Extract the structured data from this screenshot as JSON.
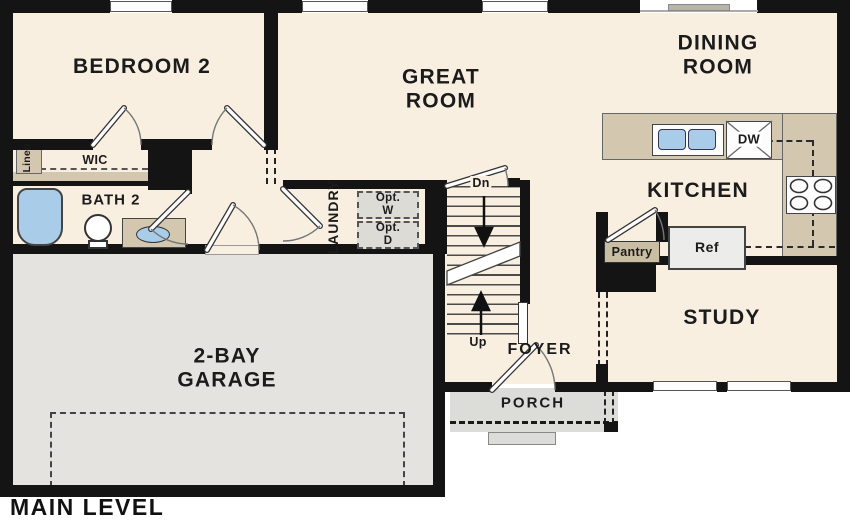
{
  "plan_title": "MAIN LEVEL",
  "labels": {
    "bedroom2": "BEDROOM 2",
    "great_room": "GREAT\nROOM",
    "dining_room": "DINING\nROOM",
    "kitchen": "KITCHEN",
    "study": "STUDY",
    "bath2": "BATH 2",
    "wic": "WIC",
    "linen": "Linen",
    "laundry": "LAUNDRY",
    "foyer": "FOYER",
    "porch": "PORCH",
    "garage": "2-BAY\nGARAGE"
  },
  "fixtures": {
    "pantry": "Pantry",
    "ref": "Ref",
    "dishwasher": "DW",
    "opt_washer": "Opt.\nW",
    "opt_dryer": "Opt.\nD"
  },
  "stairs": {
    "down": "Dn",
    "up": "Up"
  },
  "colors": {
    "floor": "#f8efe1",
    "garage_floor": "#e4e3e0",
    "porch_floor": "#dcdcd8",
    "counter_tan": "#d3c7b0",
    "wall": "#141414",
    "fixture_blue": "#a9cde9",
    "optional_fill": "#dcdbd5"
  }
}
